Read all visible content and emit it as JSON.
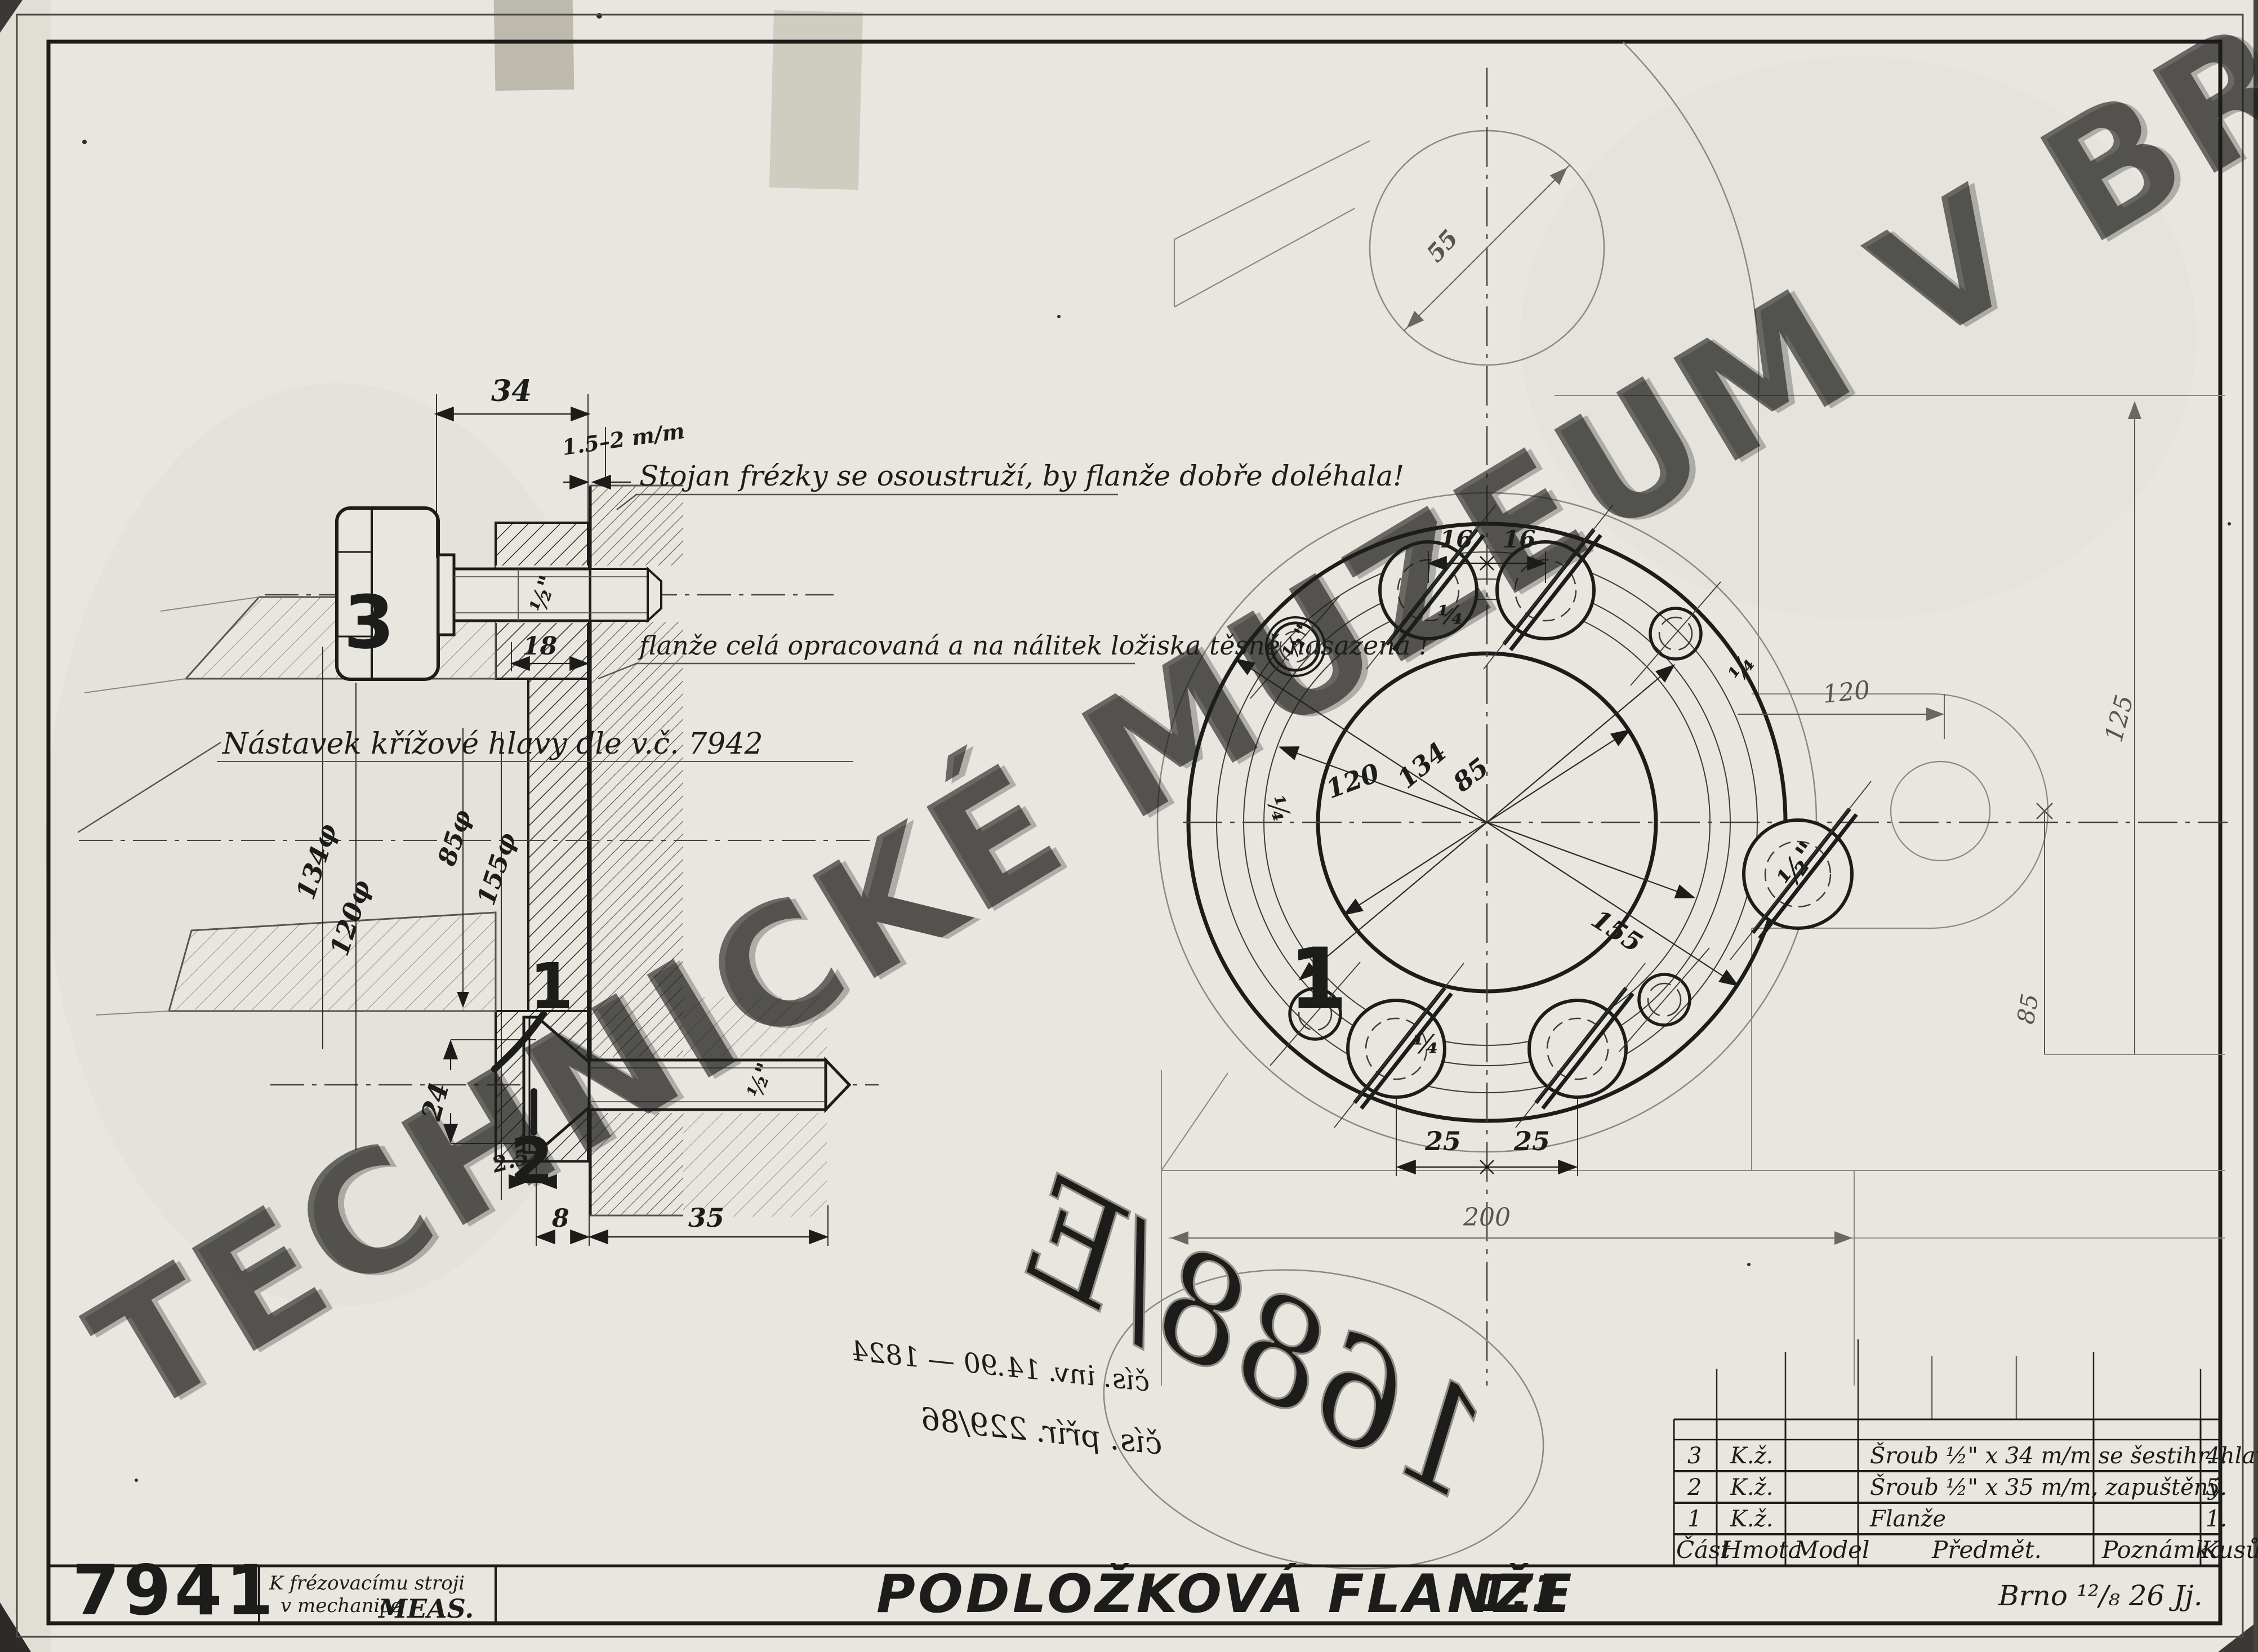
{
  "document": {
    "drawing_number": "7941",
    "title": "PODLOŽKOVÁ FLANŽE",
    "scale": "1:1",
    "usage_note_line1": "K frézovacímu stroji",
    "usage_note_line2": "v mechanice",
    "usage_note_org": "MEAS.",
    "place_date": "Brno ¹²/₈ 26 Jj.",
    "watermark": "TECHNICKÉ MUZEUM V BRNĚ"
  },
  "notes": {
    "stand": "Stojan frézky se osoustruží, by flanže dobře doléhala!",
    "flange": "flanže celá opracovaná a na nálitek ložiska těsně nasazená !",
    "adapter": "Nástavek křížové hlavy dle v.č. 7942",
    "inventory_line1": "čís. inv. 14.90 — 1824",
    "inventory_line2": "čís. přír. 229/86",
    "oval_number": "1688/E"
  },
  "section_view": {
    "callout_flange": "1",
    "callout_screw": "2",
    "callout_bolt": "3",
    "dim_34": "34",
    "dim_gap": "1.5–2 m/m",
    "dim_thread_top": "½\"",
    "dim_18": "18",
    "dia_134": "134φ",
    "dia_120": "120φ",
    "dia_85": "85φ",
    "dia_155": "155φ",
    "dim_24": "24",
    "dim_thread_bottom": "½\"",
    "dim_2_5": "2.5",
    "dim_8": "8",
    "dim_35": "35"
  },
  "front_view": {
    "callout_flange": "1",
    "dim_55": "55",
    "dim_16_left": "16",
    "dim_16_right": "16",
    "dim_125": "125",
    "dim_120_right": "120",
    "dim_85_right": "85",
    "dia_120": "120",
    "dia_134": "134",
    "dia_85": "85",
    "dia_155": "155",
    "dim_25_left": "25",
    "dim_25_right": "25",
    "dim_200": "200",
    "hole_quarter_top": "¼",
    "hole_quarter_bottom": "¼",
    "hole_quarter_left": "¼",
    "hole_quarter_right": "¼",
    "hole_half_small": "½\"",
    "hole_half_lug": "½\""
  },
  "parts_table": {
    "headers": {
      "part": "Část",
      "material": "Hmota",
      "model": "Model",
      "subject": "Předmět.",
      "note": "Poznámka",
      "qty": "Kusů"
    },
    "rows": [
      {
        "part": "3",
        "material": "K.ž.",
        "model": "",
        "subject": "Šroub ½\" x 34 m/m se šestihr. hlavou.",
        "note": "",
        "qty": "4."
      },
      {
        "part": "2",
        "material": "K.ž.",
        "model": "",
        "subject": "Šroub ½\" x 35 m/m, zapuštěný",
        "note": "",
        "qty": "5."
      },
      {
        "part": "1",
        "material": "K.ž.",
        "model": "",
        "subject": "Flanže",
        "note": "",
        "qty": "1."
      }
    ]
  },
  "colors": {
    "paper": "#e8e6df",
    "ink": "#1c1c1a",
    "pencil": "#8a887f"
  }
}
